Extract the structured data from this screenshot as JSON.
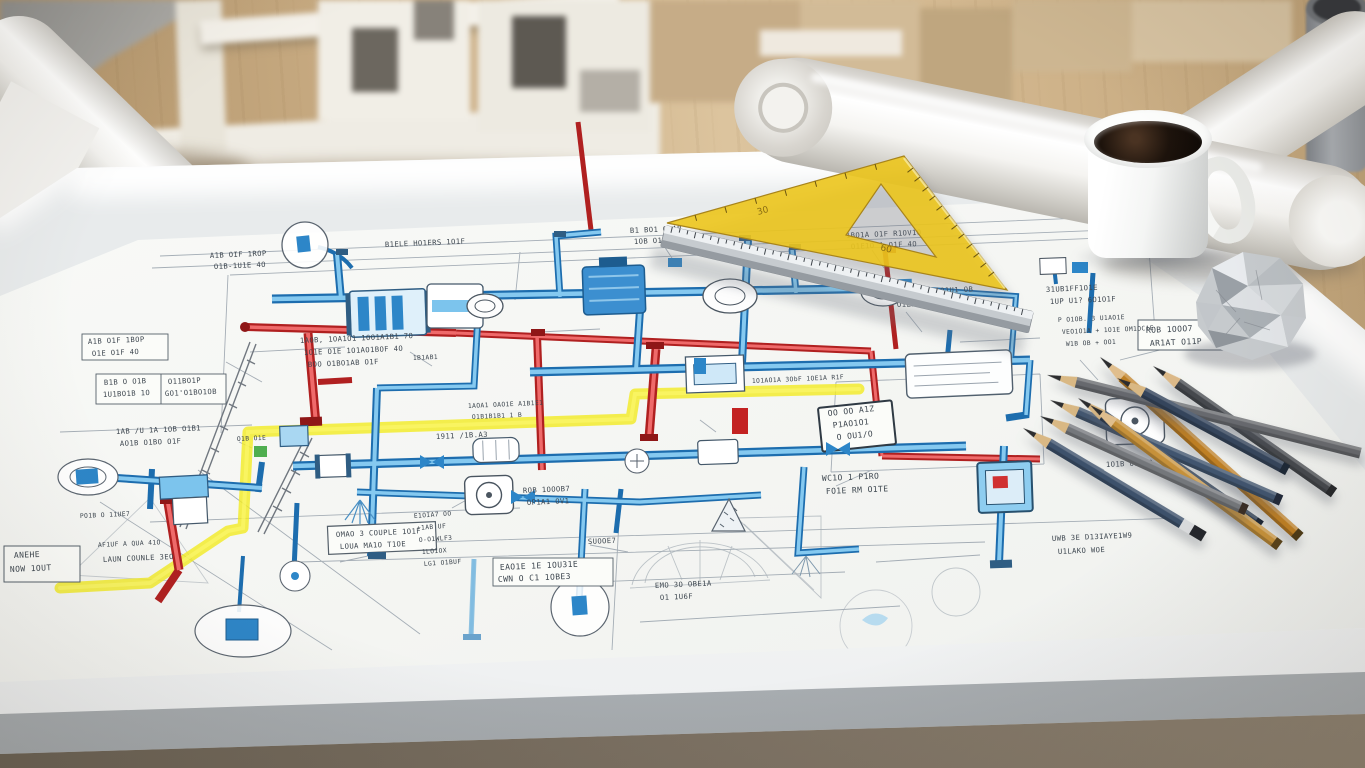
{
  "scene": {
    "type": "photorealistic render",
    "description": "Architect's drafting light table with a colored piping blueprint, yellow set square, steel ruler, scattered drafting pencils, a mug of black coffee, a crumpled paper ball, rolled blueprint tubes and white architectural models on a wooden desk"
  },
  "blueprint": {
    "colors": {
      "pipe_blue_dark": "#1d6dae",
      "pipe_blue_light": "#85c9f0",
      "pipe_red_dark": "#b02020",
      "pipe_red_light": "#ef6a6a",
      "highlight_yellow": "#f3eb22",
      "construction_gray": "#97a1ab",
      "ink": "#3c454e"
    },
    "annotations": [
      {
        "text": "A1B OIF 1ROP"
      },
      {
        "text": "O1B-1U1E 4O"
      },
      {
        "text": "B1ELE HO1ERS 1O1F"
      },
      {
        "text": "B1 BO1 O1AB"
      },
      {
        "text": "1OB O1E PO1E"
      },
      {
        "text": "1BO1A O1F R1OV1O"
      },
      {
        "text": "O1E1O 1 O1F 4O"
      },
      {
        "text": "31UB1FF1O1E"
      },
      {
        "text": "1UP U1? 6O1O1F"
      },
      {
        "text": "P O1OB. 3 U1AO1E"
      },
      {
        "text": "VEO1O1A + 1O1E OM1OC1E"
      },
      {
        "text": "W1B OB + OO1"
      },
      {
        "text": "A1B O1F 1BOP"
      },
      {
        "text": "O1E O1F 4O"
      },
      {
        "text": "B1B O O1B"
      },
      {
        "text": "1U1BO1B 1O"
      },
      {
        "text": "O11BO1P"
      },
      {
        "text": "GO1'O1BO1OB"
      },
      {
        "text": "1AB /U 1A 1OB O1B1"
      },
      {
        "text": "AO1B O1BO O1F"
      },
      {
        "text": "1AOB, 1OA1O1 1OO1A1B1 7O"
      },
      {
        "text": "1O1E O1E 1O1AO1BOF 4O"
      },
      {
        "text": "BOO O1BO1AB O1F"
      },
      {
        "text": "BU1O B. O1Q1U1 OB"
      },
      {
        "text": "O1ZBU OAOF 4O"
      },
      {
        "text": "ROB 1OOO7"
      },
      {
        "text": "AR1AT O11P"
      },
      {
        "text": "WC1O 1 P1RO"
      },
      {
        "text": "FO1E RM O1TE"
      },
      {
        "text": "UWB 3E D13IAYE1W9"
      },
      {
        "text": "U1LAKO  WOE"
      },
      {
        "text": "ANEHE"
      },
      {
        "text": "NOW 1OUT"
      },
      {
        "text": "LAUN COUNLE 3EO"
      },
      {
        "text": "AF1UF A QUA 41O"
      },
      {
        "text": "EAO1E 1E 1OU31E"
      },
      {
        "text": "CWN O C1 1OBE3"
      },
      {
        "text": "EMO 3O OBE1A"
      },
      {
        "text": "O1 1U6F"
      },
      {
        "text": "SUOOE7"
      },
      {
        "text": "1O1AO1A 3ObF 1OE1A R1F"
      },
      {
        "text": "OO OO A1Z"
      },
      {
        "text": "P1AO1O1"
      },
      {
        "text": "O OU1/O"
      },
      {
        "text": "OMAO 3 COUPLE 1O1F"
      },
      {
        "text": "LOUA MA1O T1OE"
      },
      {
        "text": "1911 /1B.A3"
      },
      {
        "text": "1AOA1 OAO1E A1B1E1"
      },
      {
        "text": "O1B1B1B1 1 B"
      },
      {
        "text": "ROB 1OOOB7"
      },
      {
        "text": "OP1A1 OV1"
      },
      {
        "text": "1O1B O1AOQ"
      },
      {
        "text": "PO1B O 11UE7"
      },
      {
        "text": "E1OIA7 OO"
      },
      {
        "text": "+1AB UF"
      },
      {
        "text": "O-O1WLF3"
      },
      {
        "text": "1LO1OX"
      },
      {
        "text": "LG1 O1BUF"
      },
      {
        "text": "O1B O1E"
      },
      {
        "text": "1B1AB1"
      },
      {
        "text": "1O1F"
      }
    ]
  },
  "objects": {
    "set_square": {
      "label": "yellow set square",
      "color": "rgba(236,197,28,0.9)",
      "markings": [
        "30",
        "60"
      ]
    },
    "ruler": {
      "label": "steel ruler"
    },
    "coffee_mug": {
      "label": "white mug with black coffee"
    },
    "paper_ball": {
      "label": "crumpled paper ball"
    },
    "rolls": {
      "label": "rolled blueprint tubes",
      "count": 3
    },
    "cup": {
      "label": "gray cup"
    },
    "models": {
      "label": "white architectural models"
    },
    "pencils": {
      "label": "drafting pencils",
      "count": 9,
      "items": [
        {
          "name": "charcoal",
          "color": "#45484d"
        },
        {
          "name": "amber",
          "color": "#bf7f23"
        },
        {
          "name": "graphite",
          "color": "#67696e"
        },
        {
          "name": "steel-blue",
          "color": "#41556f"
        },
        {
          "name": "dark-navy",
          "color": "#2e3d52"
        },
        {
          "name": "ochre",
          "color": "#c6913a"
        },
        {
          "name": "warm-gray",
          "color": "#74777b"
        },
        {
          "name": "blue-eraser",
          "color": "#3d516b"
        },
        {
          "name": "navy",
          "color": "#35455c"
        }
      ]
    }
  }
}
